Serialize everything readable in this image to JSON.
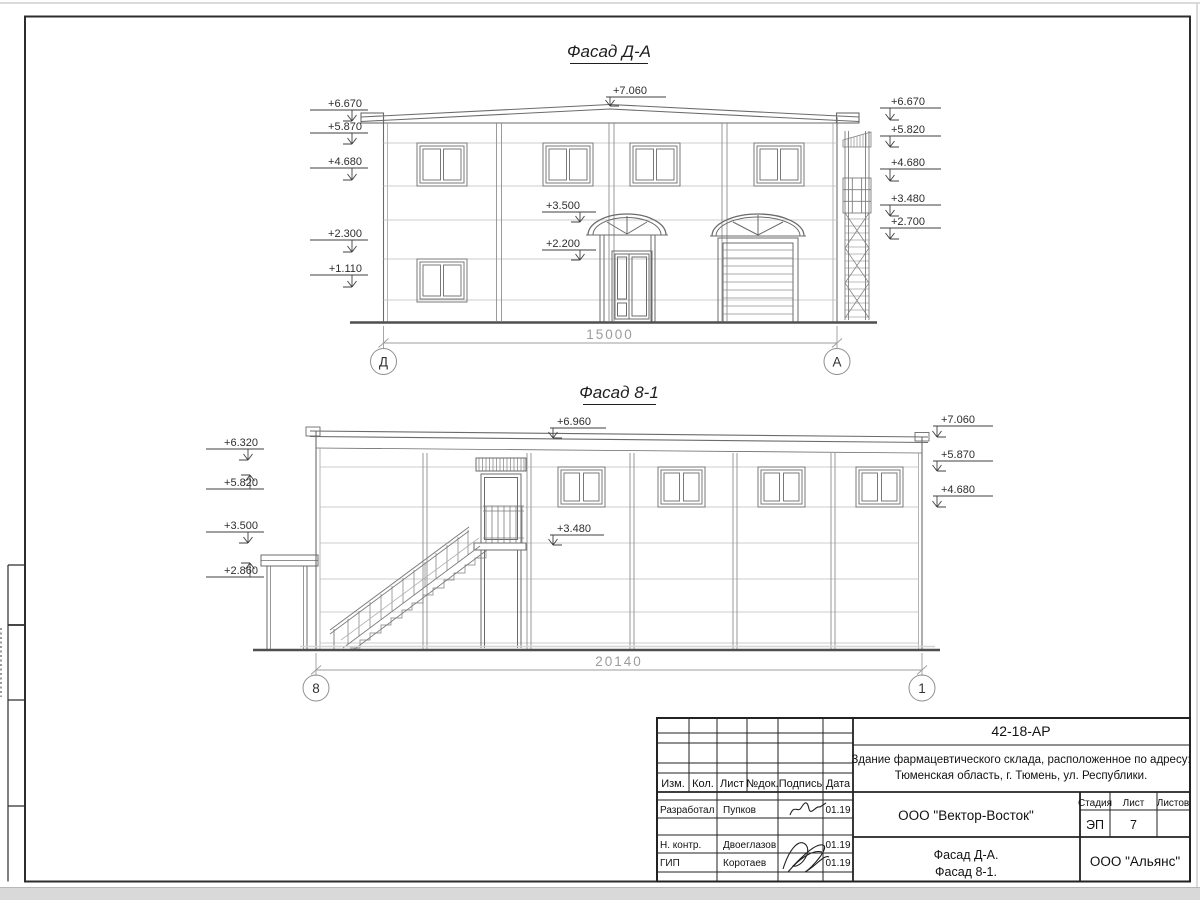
{
  "facade1": {
    "title": "Фасад Д-А",
    "marks_left": [
      "+6.670",
      "+5.870",
      "+4.680",
      "+2.300",
      "+1.110"
    ],
    "marks_center": [
      "+7.060",
      "+3.500",
      "+2.200"
    ],
    "marks_right": [
      "+6.670",
      "+5.820",
      "+4.680",
      "+3.480",
      "+2.700"
    ],
    "dimension": "15000",
    "axis_left": "Д",
    "axis_right": "А"
  },
  "facade2": {
    "title": "Фасад 8-1",
    "marks_left": [
      "+6.320",
      "+5.820",
      "+3.500",
      "+2.860"
    ],
    "marks_center": [
      "+6.960",
      "+3.480"
    ],
    "marks_right": [
      "+7.060",
      "+5.870",
      "+4.680"
    ],
    "dimension": "20140",
    "axis_left": "8",
    "axis_right": "1"
  },
  "titleblock": {
    "doc_code": "42-18-АР",
    "project_address_line1": "Здание фармацевтического склада, расположенное по адресу:",
    "project_address_line2": "Тюменская область, г. Тюмень, ул. Республики.",
    "columns": {
      "izm": "Изм.",
      "kol": "Кол.",
      "list": "Лист",
      "ndoc": "№док.",
      "podpis": "Подпись",
      "data": "Дата"
    },
    "signature_rows": [
      {
        "role": "Разработал",
        "name": "Пупков",
        "date": "01.19"
      },
      {
        "role": "Н. контр.",
        "name": "Двоеглазов",
        "date": "01.19"
      },
      {
        "role": "ГИП",
        "name": "Коротаев",
        "date": "01.19"
      }
    ],
    "designer_org": "ООО \"Вектор-Восток\"",
    "stage_label": "Стадия",
    "sheet_label": "Лист",
    "sheets_label": "Листов",
    "stage_value": "ЭП",
    "sheet_value": "7",
    "sheets_value": "",
    "sheet_content_line1": "Фасад Д-А.",
    "sheet_content_line2": "Фасад 8-1.",
    "client_org": "ООО \"Альянс\""
  },
  "palette": {
    "building_line": "#6b6b6b",
    "thin_line": "#909090",
    "seam_line": "#bdbdbd",
    "ground_line": "#4f4f4f",
    "mark_line": "#3f3f3f",
    "dim_line": "#9c9c9c",
    "frame_line": "#2d2d2d",
    "page_edge": "#d9d9d9"
  }
}
